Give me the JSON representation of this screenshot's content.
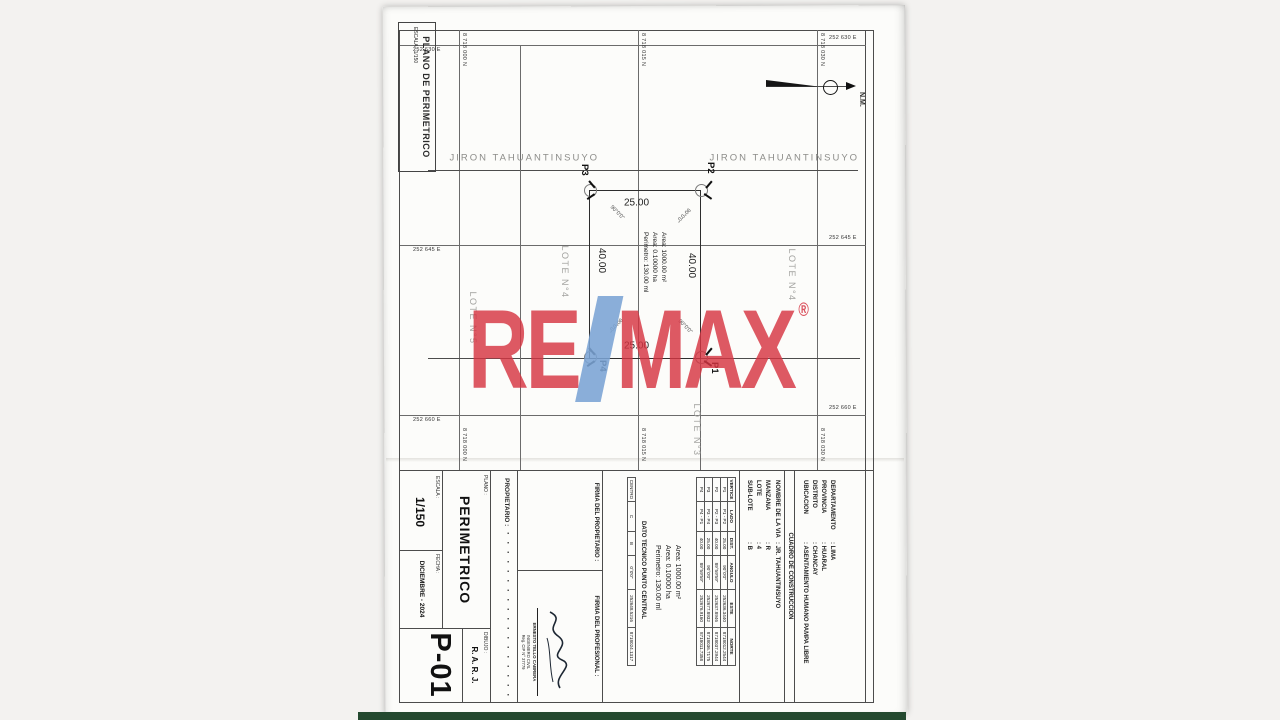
{
  "colors": {
    "watermark_red": "#d53442",
    "watermark_blue": "#7aa3d4",
    "photo_strip_green": "#24492f",
    "paper": "#fcfcfa"
  },
  "watermark": {
    "re": "RE",
    "slash": "/",
    "max": "MAX",
    "registered": "®"
  },
  "sheet": {
    "corner_box": {
      "title": "PLANO DE PERIMETRICO",
      "scale": "ESCALA : 1/150"
    },
    "compass": {
      "label": "N.M."
    },
    "streets": {
      "upper": "JIRON TAHUANTINSUYO",
      "lower": "JIRON TAHUANTINSUYO"
    },
    "lots": {
      "above": "LOTE N°4",
      "below": "LOTE N°4",
      "bottom": "LOTE N°5",
      "right": "LOTE N°3"
    },
    "grid": {
      "east": [
        {
          "label": "252 630 E"
        },
        {
          "label": "252 645 E"
        },
        {
          "label": "252 660 E"
        }
      ],
      "north": [
        {
          "label": "8 718 030 N"
        },
        {
          "label": "8 718 015 N"
        },
        {
          "label": "8 718 000 N"
        }
      ]
    },
    "parcel": {
      "v_tl": "P2",
      "v_tr": "P1",
      "v_bl": "P3",
      "v_br": "P4",
      "dim_left": "25.00",
      "dim_right": "25.00",
      "dim_top": "40.00",
      "dim_bottom": "40.00",
      "angles": [
        "90°0'0''",
        "90°0'0''",
        "90°0'0''",
        "90°0'0''"
      ],
      "area_lines": [
        "Area: 1000.00 m²",
        "Area: 0.10000 ha",
        "Perimetro: 130.00 ml"
      ]
    },
    "location": {
      "rows": [
        {
          "label": "DEPARTAMENTO",
          "value": ": LIMA"
        },
        {
          "label": "PROVINCIA",
          "value": ": HUARAL"
        },
        {
          "label": "DISTRITO",
          "value": ": CHANCAY"
        },
        {
          "label": "UBICACION",
          "value": ": ASENTAMIENTO HUMANO PAMPA LIBRE"
        }
      ]
    },
    "via": {
      "rows": [
        {
          "label": "NOMBRE DE LA VIA",
          "value": ": JR. TAHUANTINSUYO"
        },
        {
          "label": "MANZANA",
          "value": ": R"
        },
        {
          "label": "LOTE",
          "value": ": 4"
        },
        {
          "label": "SUB-LOTE",
          "value": ": B"
        }
      ]
    },
    "cuadro": {
      "title": "CUADRO DE CONSTRUCCION",
      "headers": [
        "VERTICE",
        "LADO",
        "DIST.",
        "ANGULO",
        "ESTE",
        "NORTE"
      ],
      "rows": [
        [
          "P1",
          "P1 - P2",
          "25.00",
          "90°0'0''",
          "252636.3440",
          "8718012.2544"
        ],
        [
          "P2",
          "P2 - P3",
          "40.00",
          "89°59'59''",
          "252637.8946",
          "8718037.2944"
        ],
        [
          "P3",
          "P3 - P4",
          "25.00",
          "90°0'0''",
          "252677.8932",
          "8718036.7175"
        ],
        [
          "P4",
          "P4 - P1",
          "40.00",
          "89°59'59''",
          "252676.9160",
          "8718011.7358"
        ]
      ]
    },
    "dato_tecnico": {
      "title": "DATO TECNICO PUNTO CENTRAL",
      "row": [
        "CENTRO",
        "C",
        "B",
        "0°0'0''",
        "252648.5216",
        "8718024.1317"
      ]
    },
    "firmas": {
      "owner_label": "FIRMA DEL PROPIETARIO :",
      "professional_label": "FIRMA DEL PROFESIONAL :",
      "stamp": [
        "ERNESTO TELLO CABRERA",
        "INGENIERO CIVIL",
        "Reg. CIP N° 37779"
      ]
    },
    "owner": {
      "label": "PROPIETARIO :",
      "name_redacted": "· · · · · · · · · · · · · · · · · ·"
    },
    "titleblock": {
      "plano_label": "PLANO :",
      "plano": "PERIMETRICO",
      "escala_label": "ESCALA :",
      "escala": "1/150",
      "fecha_label": "FECHA :",
      "fecha": "DICIEMBRE - 2024",
      "dibujo_label": "DIBUJO :",
      "dibujo": "R. A. R. J.",
      "sheet_number": "P-01"
    }
  }
}
